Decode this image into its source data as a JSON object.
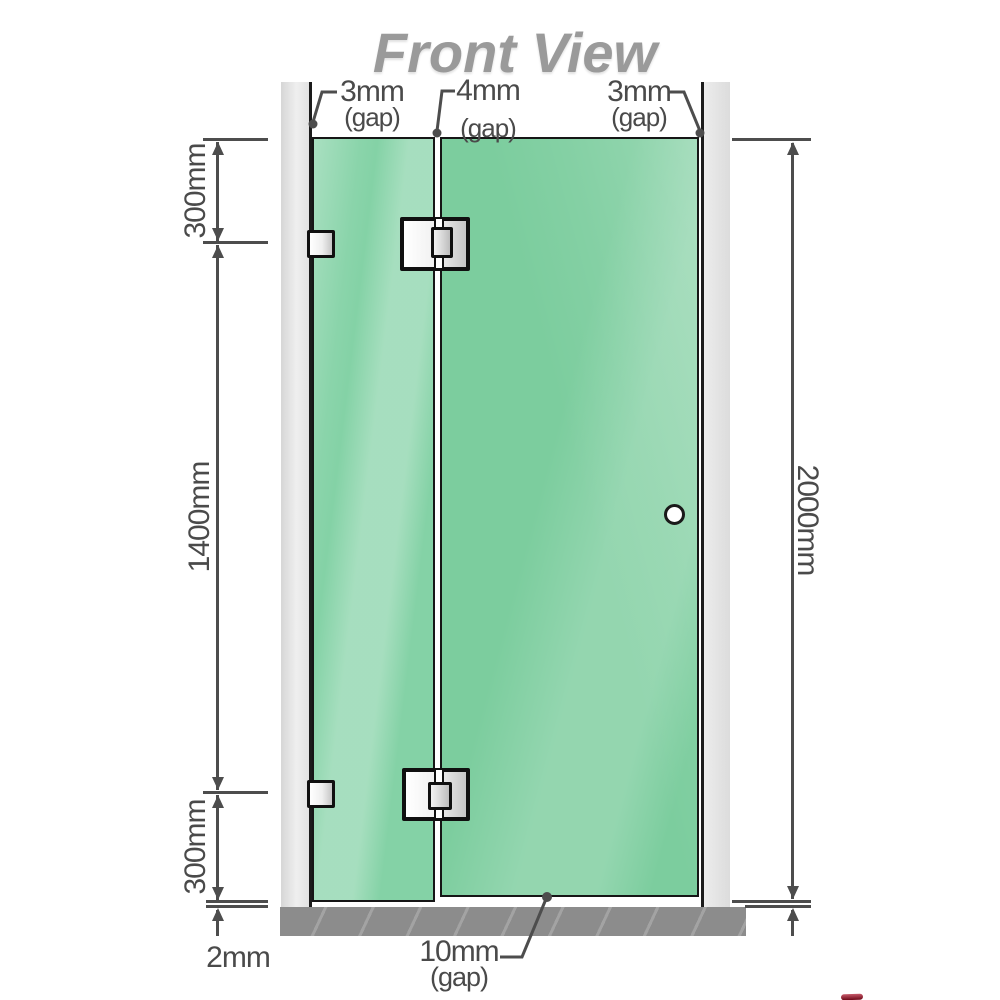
{
  "title": "Front View",
  "top_gaps": {
    "left": {
      "value": "3mm",
      "unit": "(gap)"
    },
    "middle": {
      "value": "4mm",
      "unit": "(gap)"
    },
    "right": {
      "value": "3mm",
      "unit": "(gap)"
    }
  },
  "side_dimensions": {
    "left_top": "300mm",
    "left_middle": "1400mm",
    "left_bottom": "300mm",
    "right_full": "2000mm"
  },
  "bottom_dimensions": {
    "floor_gap_left": "2mm",
    "door_floor_gap": {
      "value": "10mm",
      "unit": "(gap)"
    }
  },
  "colors": {
    "glass_green": "#7ccd9e",
    "glass_green_light": "#a8e0c2",
    "wall_gray": "#e2e2e2",
    "floor_gray": "#8c8c8c",
    "line_gray": "#4d4d4d",
    "title_gray": "#9a9a9a",
    "hardware_white": "#f2f2f2",
    "outline_black": "#161616",
    "logo_red": "#6e0818"
  }
}
